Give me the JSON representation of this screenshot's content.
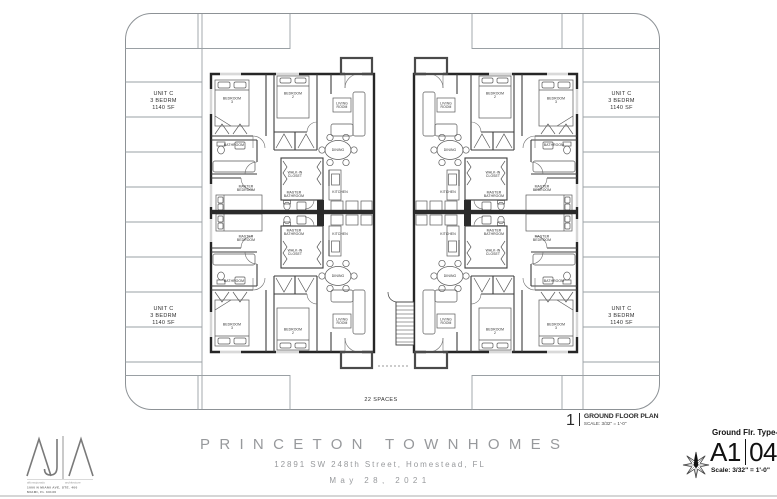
{
  "sheet": {
    "project_title": "PRINCETON TOWNHOMES",
    "project_address": "12891 SW 248th Street, Homestead, FL",
    "date": "May 28, 2021"
  },
  "drawing_callout": {
    "number": "1",
    "title": "GROUND FLOOR PLAN",
    "scale": "SCALE: 3/32\" = 1'-0\""
  },
  "title_block": {
    "sheet_name": "Ground Flr. Type-C",
    "sheet_series": "A1",
    "sheet_number": "04",
    "scale": "Scale: 3/32\" = 1'-0\"",
    "north_icon": "compass-star"
  },
  "architect": {
    "firm_left": "alfonsojurado",
    "firm_right": "architecture",
    "address_line1": "1000 N MIAMI AVE, STE. 400",
    "address_line2": "MIAMI, FL 33136",
    "address_line3": "T 305.350.6214"
  },
  "site_plan": {
    "spaces_label": "22 SPACES",
    "unit_label": [
      "UNIT C",
      "3 BEDRM",
      "1140 SF"
    ],
    "unit_count": 4,
    "rooms": {
      "bedroom3": [
        "BEDROOM",
        "3"
      ],
      "bedroom2": [
        "BEDROOM",
        "2"
      ],
      "living_room": [
        "LIVING",
        "ROOM"
      ],
      "bathroom": [
        "BATHROOM"
      ],
      "dining": [
        "DINING"
      ],
      "walkin_closet": [
        "WALK-IN",
        "CLOSET"
      ],
      "master_bedroom": [
        "MASTER",
        "BEDROOM"
      ],
      "master_bathroom": [
        "MASTER",
        "BATHROOM"
      ],
      "kitchen": [
        "KITCHEN"
      ]
    }
  },
  "colors": {
    "wall": "#262626",
    "partition": "#3c3c3c",
    "furniture": "#5a5a5a",
    "parking_line": "#9aa0a4",
    "site_border": "#8d9296",
    "label_text": "#2f2f2f",
    "title_gray": "#97999c",
    "ink": "#1c1c1c"
  }
}
